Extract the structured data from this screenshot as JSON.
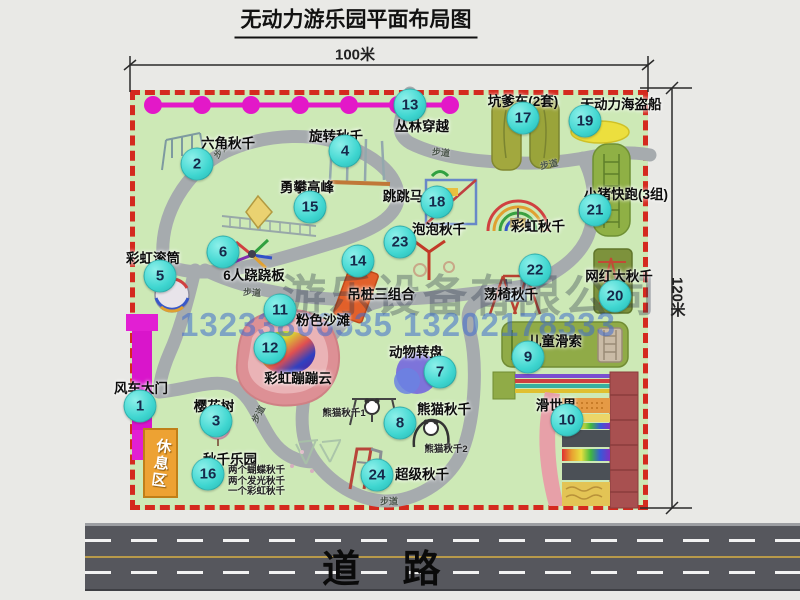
{
  "title": "无动力游乐园平面布局图",
  "dimensions": {
    "width": "100米",
    "height": "120米"
  },
  "road": {
    "label": "道 路"
  },
  "watermark": {
    "company": "游乐设备有限公司",
    "phone": "13233806535 13202178333"
  },
  "map": {
    "walkway": "步道",
    "rest_area": "休息区",
    "rainbow_swing": "彩虹秋千",
    "panda_swing_1": "熊猫秋千1",
    "panda_swing_2": "熊猫秋千2",
    "swing_park_notes": [
      "两个蝴蝶秋千",
      "两个发光秋千",
      "一个彩虹秋千"
    ],
    "items": [
      {
        "num": "1",
        "label": "风车大门"
      },
      {
        "num": "2",
        "label": "六角秋千"
      },
      {
        "num": "3",
        "label": "樱花树"
      },
      {
        "num": "4",
        "label": "旋转秋千"
      },
      {
        "num": "5",
        "label": "彩虹滚筒"
      },
      {
        "num": "6",
        "label": "6人跷跷板"
      },
      {
        "num": "7",
        "label": "动物转盘"
      },
      {
        "num": "8",
        "label": "熊猫秋千"
      },
      {
        "num": "9",
        "label": "儿童滑索"
      },
      {
        "num": "10",
        "label": "滑世界"
      },
      {
        "num": "11",
        "label": "粉色沙滩"
      },
      {
        "num": "12",
        "label": "彩虹蹦蹦云"
      },
      {
        "num": "13",
        "label": "丛林穿越"
      },
      {
        "num": "14",
        "label": "吊桩三组合"
      },
      {
        "num": "15",
        "label": "勇攀高峰"
      },
      {
        "num": "16",
        "label": "秋千乐园"
      },
      {
        "num": "17",
        "label": "坑爹车(2套)"
      },
      {
        "num": "18",
        "label": "跳跳马"
      },
      {
        "num": "19",
        "label": "无动力海盗船"
      },
      {
        "num": "20",
        "label": "网红大秋千"
      },
      {
        "num": "21",
        "label": "小猪快跑(3组)"
      },
      {
        "num": "22",
        "label": "荡椅秋千"
      },
      {
        "num": "23",
        "label": "泡泡秋千"
      },
      {
        "num": "24",
        "label": "超级秋千"
      }
    ]
  },
  "colors": {
    "map_bg": "#cde9b6",
    "boundary": "#d42a1e",
    "badge": "#3fd6d0",
    "gate": "#e01ec8",
    "road": "#56575d",
    "path": "#a6abae"
  }
}
